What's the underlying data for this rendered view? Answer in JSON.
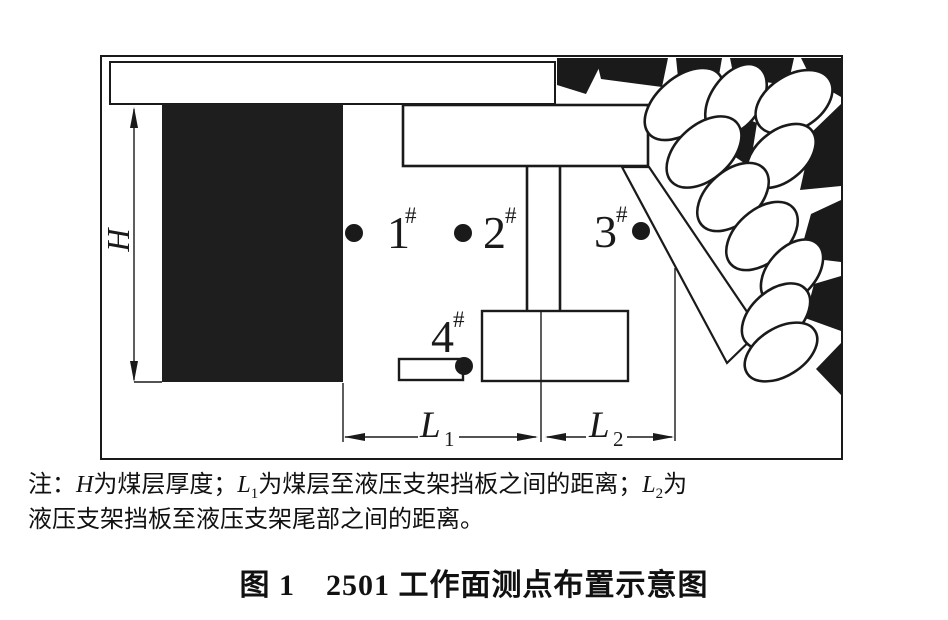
{
  "figure": {
    "caption": "图 1　2501 工作面测点布置示意图",
    "note": {
      "prefix": "注：",
      "h_var": "H",
      "h_text": "为煤层厚度；",
      "l1_var": "L",
      "l1_sub": "1",
      "l1_text": "为煤层至液压支架挡板之间的距离；",
      "l2_var": "L",
      "l2_sub": "2",
      "l2_text": "为",
      "line2": "液压支架挡板至液压支架尾部之间的距离。"
    },
    "dims": {
      "h": "H",
      "l_base": "L",
      "l1_sub": "1",
      "l2_sub": "2"
    },
    "points": [
      {
        "num": "1",
        "sup": "#"
      },
      {
        "num": "2",
        "sup": "#"
      },
      {
        "num": "3",
        "sup": "#"
      },
      {
        "num": "4",
        "sup": "#"
      }
    ],
    "colors": {
      "roof_gray": "#c9c9c9",
      "coal_black": "#1e1e1e",
      "ink": "#1a1a1a",
      "paper": "#ffffff"
    }
  }
}
